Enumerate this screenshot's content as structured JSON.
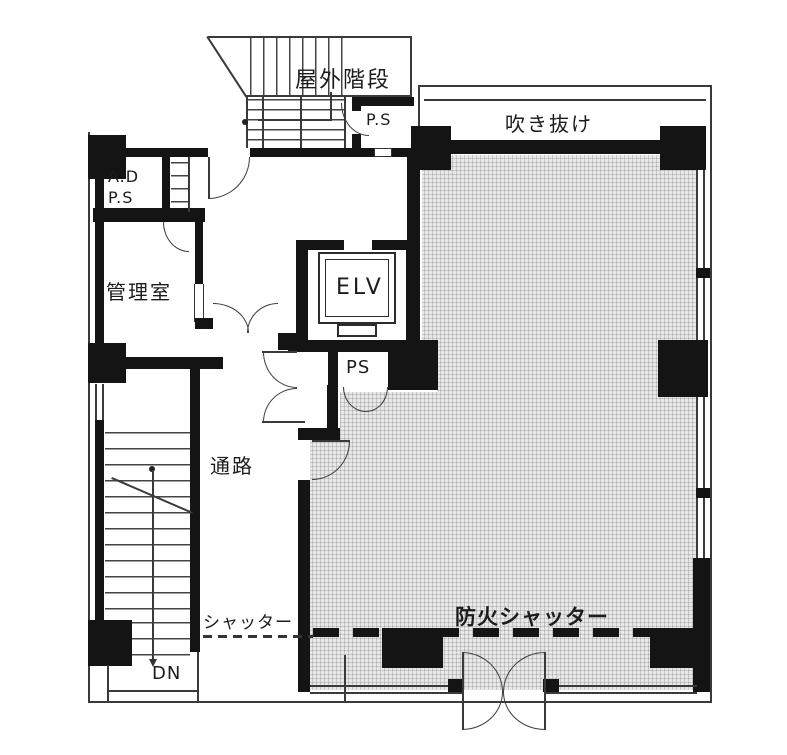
{
  "plan": {
    "labels": {
      "outdoor_stairs": "屋外階段",
      "ps_upper": "P.S",
      "atrium": "吹き抜け",
      "ad": "A.D",
      "ps_shaft": "P.S",
      "manager_room": "管理室",
      "elevator": "ELV",
      "ps_mid": "PS",
      "corridor": "通路",
      "shutter": "シャッター",
      "fire_shutter": "防火シャッター",
      "down": "DN"
    },
    "colors": {
      "wall": "#141414",
      "line": "#3a3a3a",
      "hatch_bg": "#e8e8e8",
      "paper": "#ffffff",
      "text": "#1c1c1c"
    }
  }
}
